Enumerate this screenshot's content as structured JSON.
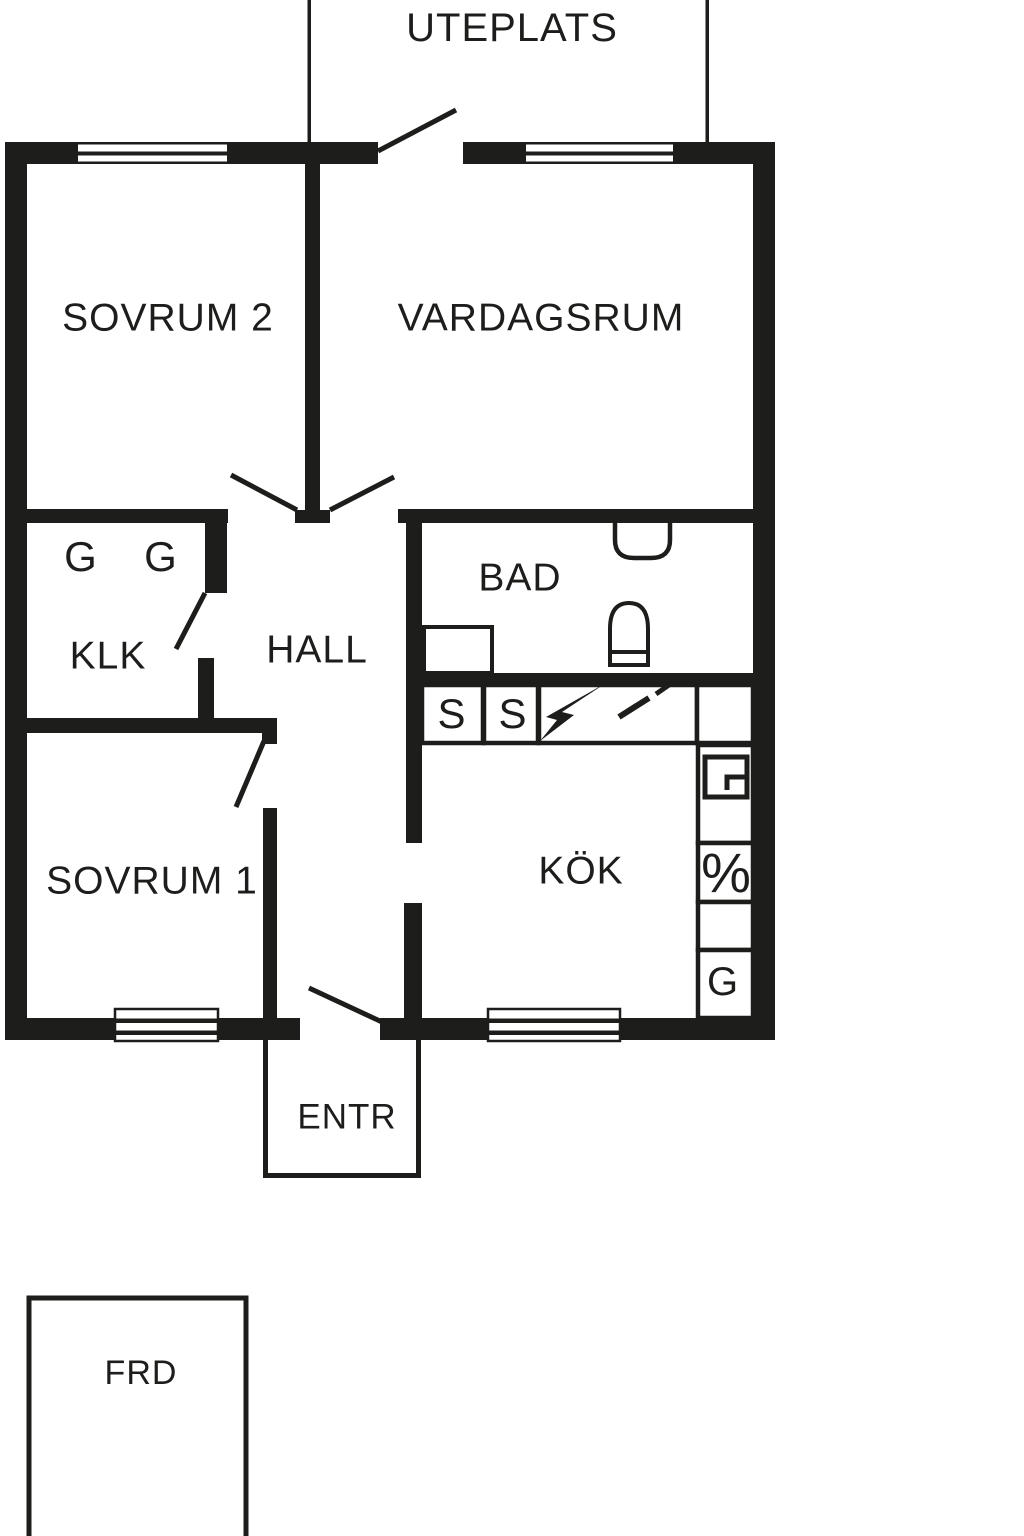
{
  "colors": {
    "wall": "#1d1d1b",
    "background": "#ffffff"
  },
  "rooms": {
    "uteplats": "UTEPLATS",
    "sovrum2": "SOVRUM 2",
    "vardagsrum": "VARDAGSRUM",
    "klk": "KLK",
    "hall": "HALL",
    "bad": "BAD",
    "sovrum1": "SOVRUM 1",
    "kok": "KÖK",
    "entr": "ENTR",
    "frd": "FRD"
  },
  "closets": {
    "wardrobe_1": "G",
    "wardrobe_2": "G"
  },
  "kitchen": {
    "cabinet_1": "S",
    "cabinet_2": "S",
    "stove_symbol": "%",
    "fridge": "G"
  }
}
